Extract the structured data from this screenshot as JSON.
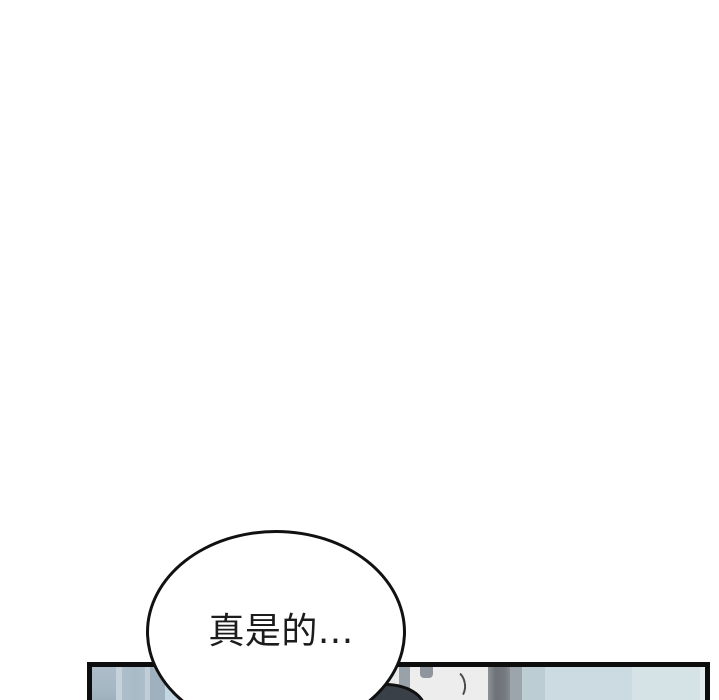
{
  "comic": {
    "background_color": "#ffffff",
    "speech_bubble": {
      "text": "真是的...",
      "fill": "#ffffff",
      "stroke": "#111111"
    },
    "panel": {
      "border_color": "#0d0d0d",
      "scene_colors": {
        "wall_left": "#a9bac7",
        "wall_stripe_light": "#c7d1da",
        "wall_accent_blue": "#c2d7e1",
        "door_surface": "#ededed",
        "door_frame_edge": "#9aa2a9",
        "door_frame_dark": "#6d7278",
        "door_frame_mid": "#9ca5ab",
        "wall_blue": "#cbdbe1",
        "wall_blue_light": "#d5e2e6",
        "door_tab": "#8e959c",
        "character_hair": "#3a4047"
      }
    }
  }
}
